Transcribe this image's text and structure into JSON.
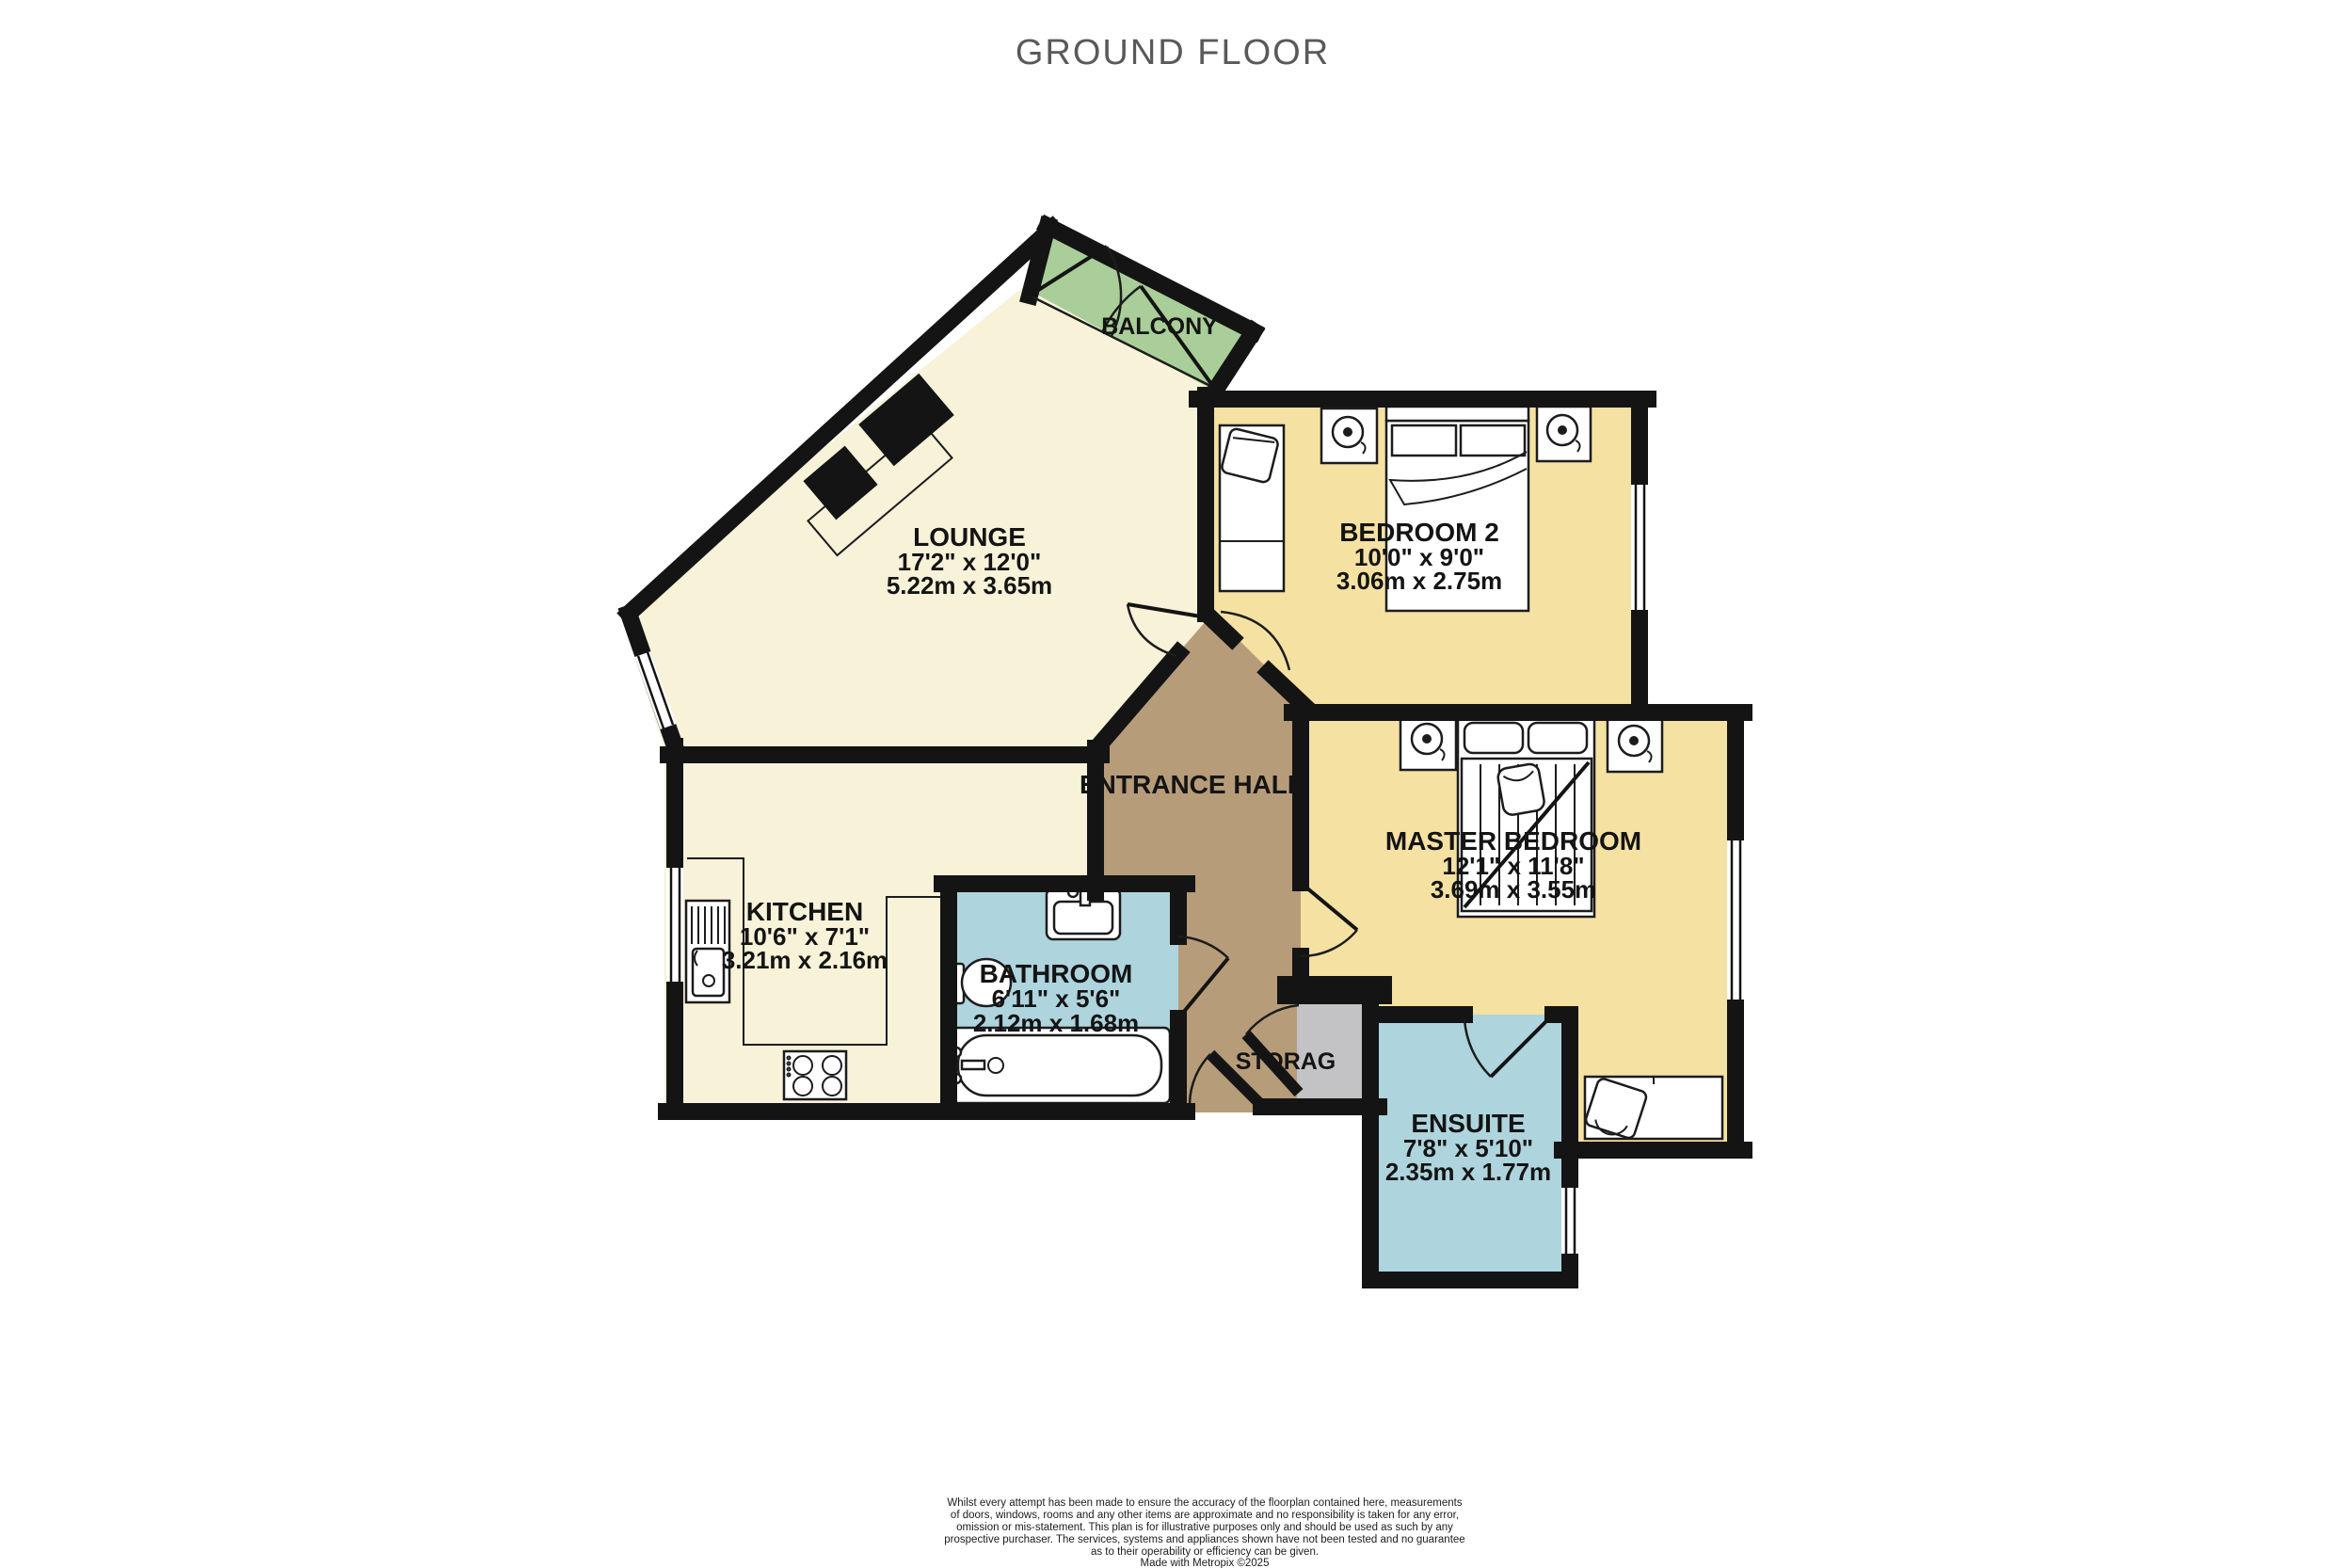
{
  "title": "GROUND FLOOR",
  "colors": {
    "lounge_kitchen_cream": "#f7f2d8",
    "bedroom_yellow": "#f5e1a2",
    "balcony_green": "#a9ce99",
    "bathroom_blue": "#aed4dd",
    "hall_brown": "#b69c79",
    "storage_gray": "#c3c2c4",
    "wall_black": "#141414",
    "title_gray": "#595959"
  },
  "rooms": {
    "lounge": {
      "name": "LOUNGE",
      "imperial": "17'2\"  x 12'0\"",
      "metric": "5.22m  x 3.65m"
    },
    "balcony": {
      "name": "BALCONY"
    },
    "bedroom2": {
      "name": "BEDROOM 2",
      "imperial": "10'0\"  x 9'0\"",
      "metric": "3.06m  x 2.75m"
    },
    "entrance_hall": {
      "name": "ENTRANCE HALL"
    },
    "kitchen": {
      "name": "KITCHEN",
      "imperial": "10'6\"  x 7'1\"",
      "metric": "3.21m  x 2.16m"
    },
    "bathroom": {
      "name": "BATHROOM",
      "imperial": "6'11\"  x 5'6\"",
      "metric": "2.12m  x 1.68m"
    },
    "master_bedroom": {
      "name": "MASTER BEDROOM",
      "imperial": "12'1\"  x 11'8\"",
      "metric": "3.69m  x 3.55m"
    },
    "storage": {
      "name": "STORAG"
    },
    "ensuite": {
      "name": "ENSUITE",
      "imperial": "7'8\"  x 5'10\"",
      "metric": "2.35m  x 1.77m"
    }
  },
  "footer": {
    "disclaimer": [
      "Whilst every attempt has been made to ensure the accuracy of the floorplan contained here, measurements",
      "of doors, windows, rooms and any other items are approximate and no responsibility is taken for any error,",
      "omission or mis-statement. This plan is for illustrative purposes only and should be used as such by any",
      "prospective purchaser. The services, systems and appliances shown have not been tested and no guarantee",
      "as to their operability or efficiency can be given."
    ],
    "credit": "Made with Metropix ©2025"
  }
}
